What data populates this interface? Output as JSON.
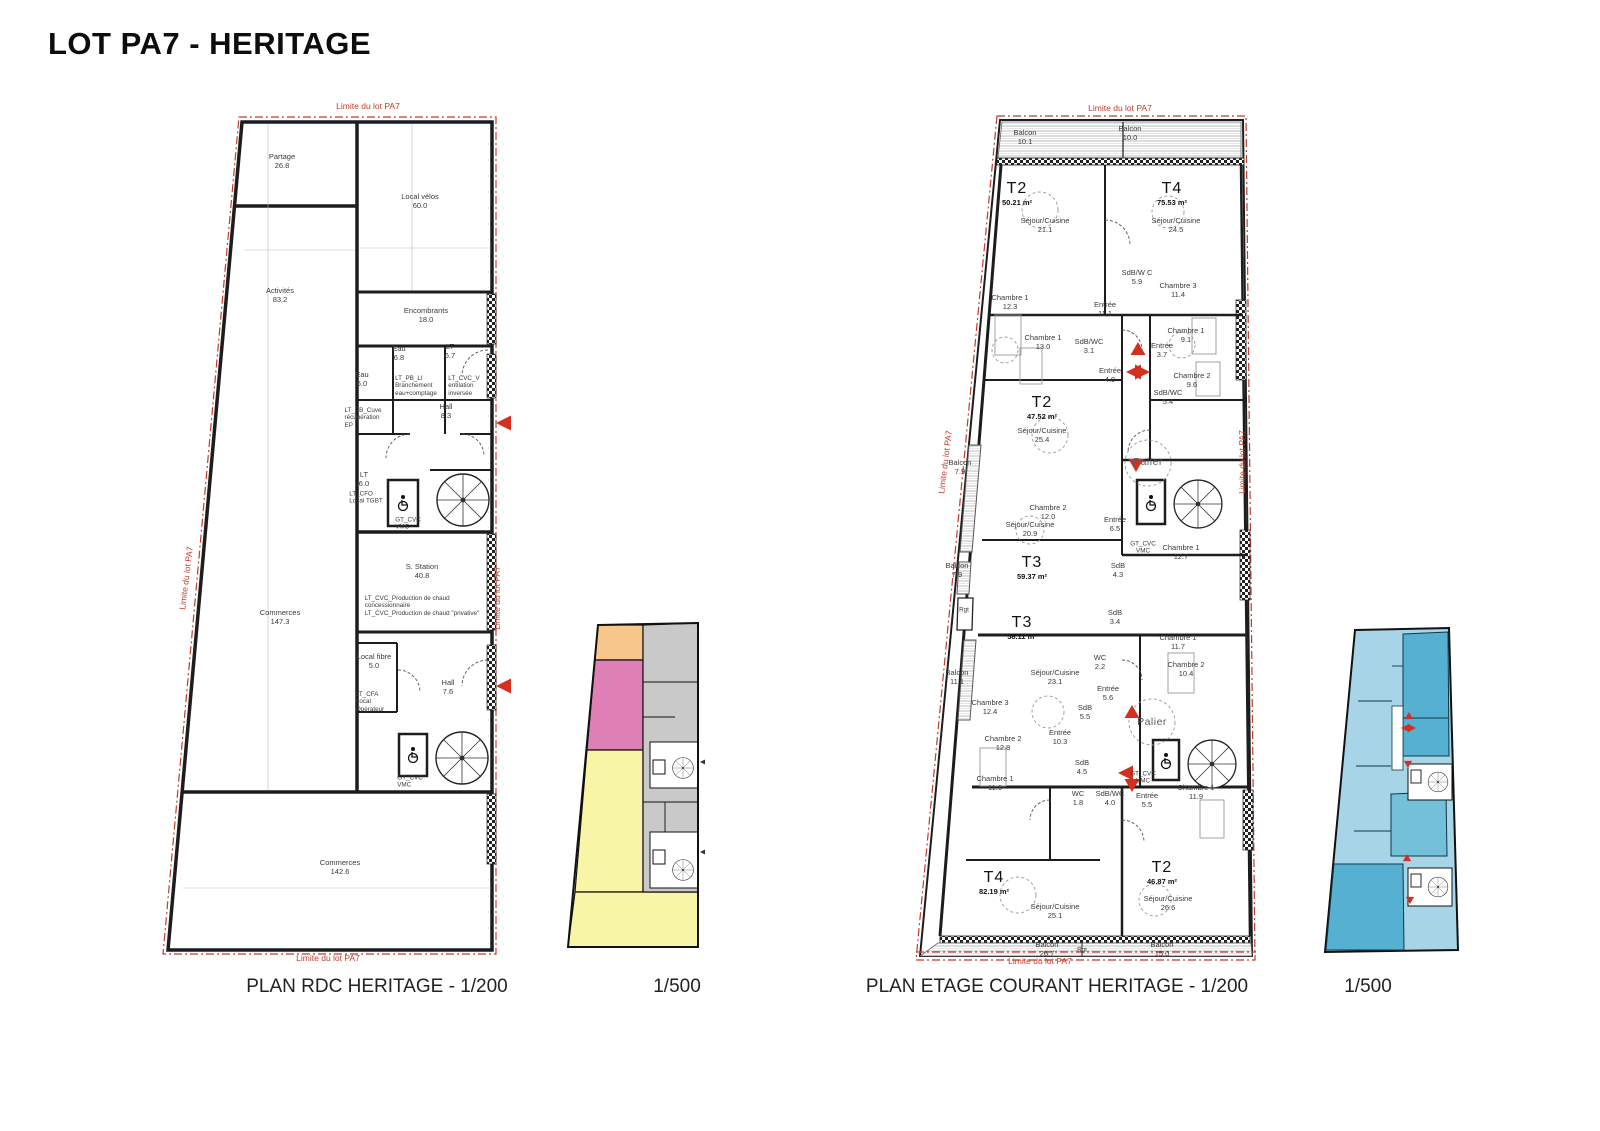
{
  "title": "LOT PA7 - HERITAGE",
  "boundary_label": "Limite du lot PA7",
  "captions": {
    "rdc": "PLAN RDC HERITAGE - 1/200",
    "rdc_key": "1/500",
    "etage": "PLAN ETAGE COURANT HERITAGE - 1/200",
    "etage_key": "1/500"
  },
  "colors": {
    "boundary_red": "#C23B2B",
    "wall_black": "#1D1D1D",
    "arrow_red": "#D43020",
    "key_orange": "#F6C68C",
    "key_pink": "#DE7FB5",
    "key_yellow": "#F8F6A6",
    "key_gray": "#C9C9C9",
    "key_blue_light": "#A7D4E6",
    "key_blue_dark": "#56B0D2"
  },
  "rdc": {
    "labels": [
      {
        "id": "room-partage",
        "x": 132,
        "y": 62,
        "t": [
          "Partage",
          "26.8"
        ]
      },
      {
        "id": "room-local-velos",
        "x": 270,
        "y": 102,
        "t": [
          "Local vélos",
          "60.0"
        ]
      },
      {
        "id": "room-activites",
        "x": 130,
        "y": 196,
        "t": [
          "Activités",
          "83.2"
        ]
      },
      {
        "id": "room-encombrants",
        "x": 276,
        "y": 216,
        "t": [
          "Encombrants",
          "18.0"
        ]
      },
      {
        "id": "room-eau-1",
        "x": 249,
        "y": 254,
        "t": [
          "Eau",
          "6.8"
        ]
      },
      {
        "id": "room-lt-1",
        "x": 300,
        "y": 252,
        "t": [
          "LT",
          "6.7"
        ]
      },
      {
        "id": "room-eau-2",
        "x": 212,
        "y": 280,
        "t": [
          "Eau",
          "6.0"
        ]
      },
      {
        "id": "room-lt-pb-li",
        "x": 266,
        "y": 286,
        "t": [
          "LT_PB_LI",
          "Branchement",
          "eau+comptage"
        ],
        "s": "small left"
      },
      {
        "id": "room-lt-cvc-vi",
        "x": 314,
        "y": 286,
        "t": [
          "LT_CVC_V",
          "entilation",
          "inversée"
        ],
        "s": "small left"
      },
      {
        "id": "room-lt-pb-cuve",
        "x": 213,
        "y": 318,
        "t": [
          "LT_PB_Cuve",
          "récupération",
          "EP"
        ],
        "s": "small left"
      },
      {
        "id": "room-hall-1",
        "x": 296,
        "y": 312,
        "t": [
          "Hall",
          "8.3"
        ]
      },
      {
        "id": "room-lt-2",
        "x": 214,
        "y": 380,
        "t": [
          "LT",
          "6.0"
        ]
      },
      {
        "id": "room-lt-cfo",
        "x": 216,
        "y": 398,
        "t": [
          "LT_CFO",
          "Local TGBT"
        ],
        "s": "small left"
      },
      {
        "id": "room-gt-cvc-1",
        "x": 258,
        "y": 424,
        "t": [
          "GT_CVC",
          "VMC"
        ],
        "s": "small left"
      },
      {
        "id": "room-commerces-1",
        "x": 130,
        "y": 518,
        "t": [
          "Commerces",
          "147.3"
        ]
      },
      {
        "id": "room-s-station",
        "x": 272,
        "y": 472,
        "t": [
          "S. Station",
          "40.8"
        ]
      },
      {
        "id": "note-production-chaud",
        "x": 272,
        "y": 506,
        "t": [
          "LT_CVC_Production de chaud",
          "concessionnaire",
          "LT_CVC_Production de chaud \"privative\""
        ],
        "s": "small left"
      },
      {
        "id": "room-local-fibre",
        "x": 224,
        "y": 562,
        "t": [
          "Local fibre",
          "5.0"
        ]
      },
      {
        "id": "room-lt-cfa",
        "x": 220,
        "y": 602,
        "t": [
          "LT_CFA",
          "Local",
          "Opérateur"
        ],
        "s": "small left"
      },
      {
        "id": "room-hall-2",
        "x": 298,
        "y": 588,
        "t": [
          "Hall",
          "7.6"
        ]
      },
      {
        "id": "room-gt-cvc-2",
        "x": 260,
        "y": 682,
        "t": [
          "GT_CVC",
          "VMC"
        ],
        "s": "small left"
      },
      {
        "id": "room-commerces-2",
        "x": 190,
        "y": 768,
        "t": [
          "Commerces",
          "142.6"
        ]
      },
      {
        "id": "boundary-top",
        "x": 218,
        "y": 6,
        "t": [
          "Limite du lot PA7"
        ],
        "s": "red"
      },
      {
        "id": "boundary-bottom",
        "x": 178,
        "y": 858,
        "t": [
          "Limite du lot PA7"
        ],
        "s": "red"
      },
      {
        "id": "boundary-left",
        "x": 36,
        "y": 478,
        "t": [
          "Limite du lot PA7"
        ],
        "s": "red rotl"
      },
      {
        "id": "boundary-right",
        "x": 347,
        "y": 498,
        "t": [
          "Limite du lot PA7"
        ],
        "s": "red rotr"
      }
    ]
  },
  "etage": {
    "labels": [
      {
        "id": "balcon-1",
        "x": 125,
        "y": 38,
        "t": [
          "Balcon",
          "10.1"
        ]
      },
      {
        "id": "balcon-2",
        "x": 230,
        "y": 34,
        "t": [
          "Balcon",
          "10.0"
        ]
      },
      {
        "id": "apt-t2-a",
        "x": 117,
        "y": 94,
        "t": [
          "T2",
          "50.21 m²"
        ],
        "s": "apt"
      },
      {
        "id": "sejour-cuisine-a",
        "x": 145,
        "y": 126,
        "t": [
          "Séjour/Cuisine",
          "21.1"
        ]
      },
      {
        "id": "apt-t4-a",
        "x": 272,
        "y": 94,
        "t": [
          "T4",
          "75.53 m²"
        ],
        "s": "apt"
      },
      {
        "id": "sejour-cuisine-b",
        "x": 276,
        "y": 126,
        "t": [
          "Séjour/Cuisine",
          "24.5"
        ]
      },
      {
        "id": "sdb-a",
        "x": 237,
        "y": 178,
        "t": [
          "SdB/W C",
          "5.9"
        ]
      },
      {
        "id": "chambre3-a",
        "x": 278,
        "y": 191,
        "t": [
          "Chambre 3",
          "11.4"
        ]
      },
      {
        "id": "chambre1-a",
        "x": 110,
        "y": 203,
        "t": [
          "Chambre 1",
          "12.3"
        ]
      },
      {
        "id": "entree-a",
        "x": 205,
        "y": 210,
        "t": [
          "Entrée",
          "11.1"
        ]
      },
      {
        "id": "chambre1-b",
        "x": 143,
        "y": 243,
        "t": [
          "Chambre 1",
          "13.0"
        ]
      },
      {
        "id": "sdb-b",
        "x": 189,
        "y": 247,
        "t": [
          "SdB/WC",
          "3.1"
        ]
      },
      {
        "id": "entree-b",
        "x": 262,
        "y": 251,
        "t": [
          "Entrée",
          "3.7"
        ]
      },
      {
        "id": "chambre1-c",
        "x": 286,
        "y": 236,
        "t": [
          "Chambre 1",
          "9.1"
        ]
      },
      {
        "id": "chambre2-a",
        "x": 292,
        "y": 281,
        "t": [
          "Chambre 2",
          "9.6"
        ]
      },
      {
        "id": "entree-c",
        "x": 210,
        "y": 276,
        "t": [
          "Entrée",
          "4.0"
        ]
      },
      {
        "id": "apt-t2-b",
        "x": 142,
        "y": 308,
        "t": [
          "T2",
          "47.52 m²"
        ],
        "s": "apt"
      },
      {
        "id": "sejour-cuisine-c",
        "x": 142,
        "y": 336,
        "t": [
          "Séjour/Cuisine",
          "25.4"
        ]
      },
      {
        "id": "sdb-c",
        "x": 268,
        "y": 298,
        "t": [
          "SdB/WC",
          "5.4"
        ]
      },
      {
        "id": "palier-1",
        "x": 248,
        "y": 362,
        "t": [
          "Palier"
        ],
        "s": "palier"
      },
      {
        "id": "balcon-3",
        "x": 60,
        "y": 368,
        "t": [
          "Balcon",
          "7.9"
        ]
      },
      {
        "id": "chambre2-b",
        "x": 148,
        "y": 413,
        "t": [
          "Chambre 2",
          "12.0"
        ]
      },
      {
        "id": "sejour-cuisine-d",
        "x": 130,
        "y": 430,
        "t": [
          "Séjour/Cuisine",
          "20.9"
        ]
      },
      {
        "id": "entree-d",
        "x": 215,
        "y": 425,
        "t": [
          "Entrée",
          "6.5"
        ]
      },
      {
        "id": "gt-cvc-a",
        "x": 243,
        "y": 448,
        "t": [
          "GT_CVC",
          "VMC"
        ],
        "s": "small"
      },
      {
        "id": "chambre1-d",
        "x": 281,
        "y": 453,
        "t": [
          "Chambre 1",
          "12.7"
        ]
      },
      {
        "id": "sdb-d",
        "x": 218,
        "y": 471,
        "t": [
          "SdB",
          "4.3"
        ]
      },
      {
        "id": "apt-t3-a",
        "x": 132,
        "y": 468,
        "t": [
          "T3",
          "59.37 m²"
        ],
        "s": "apt"
      },
      {
        "id": "balcon-4",
        "x": 57,
        "y": 471,
        "t": [
          "Balcon",
          "7.9"
        ]
      },
      {
        "id": "rgt-a",
        "x": 64,
        "y": 510,
        "t": [
          "Rgt"
        ],
        "s": "small"
      },
      {
        "id": "apt-t3-b",
        "x": 122,
        "y": 528,
        "t": [
          "T3",
          "58.11 m²"
        ],
        "s": "apt"
      },
      {
        "id": "sdb-e",
        "x": 215,
        "y": 518,
        "t": [
          "SdB",
          "3.4"
        ]
      },
      {
        "id": "chambre1-e",
        "x": 278,
        "y": 543,
        "t": [
          "Chambre 1",
          "11.7"
        ]
      },
      {
        "id": "wc-a",
        "x": 200,
        "y": 563,
        "t": [
          "WC",
          "2.2"
        ]
      },
      {
        "id": "sejour-cuisine-e",
        "x": 155,
        "y": 578,
        "t": [
          "Séjour/Cuisine",
          "23.1"
        ]
      },
      {
        "id": "chambre2-c",
        "x": 286,
        "y": 570,
        "t": [
          "Chambre 2",
          "10.4"
        ]
      },
      {
        "id": "balcon-5",
        "x": 57,
        "y": 578,
        "t": [
          "Balcon",
          "11.1"
        ]
      },
      {
        "id": "entree-e",
        "x": 208,
        "y": 594,
        "t": [
          "Entrée",
          "5.6"
        ]
      },
      {
        "id": "palier-2",
        "x": 252,
        "y": 622,
        "t": [
          "Palier"
        ],
        "s": "palier"
      },
      {
        "id": "chambre3-b",
        "x": 90,
        "y": 608,
        "t": [
          "Chambre 3",
          "12.4"
        ]
      },
      {
        "id": "sdb-f",
        "x": 185,
        "y": 613,
        "t": [
          "SdB",
          "5.5"
        ]
      },
      {
        "id": "chambre2-d",
        "x": 103,
        "y": 644,
        "t": [
          "Chambre 2",
          "12.8"
        ]
      },
      {
        "id": "entree-f",
        "x": 160,
        "y": 638,
        "t": [
          "Entrée",
          "10.3"
        ]
      },
      {
        "id": "sdb-g",
        "x": 182,
        "y": 668,
        "t": [
          "SdB",
          "4.5"
        ]
      },
      {
        "id": "gt-cvc-b",
        "x": 243,
        "y": 678,
        "t": [
          "GT_CVC",
          "VMC"
        ],
        "s": "small"
      },
      {
        "id": "entree-g",
        "x": 247,
        "y": 701,
        "t": [
          "Entrée",
          "5.5"
        ]
      },
      {
        "id": "chambre1-f",
        "x": 95,
        "y": 684,
        "t": [
          "Chambre 1",
          "11.6"
        ]
      },
      {
        "id": "wc-b",
        "x": 178,
        "y": 699,
        "t": [
          "WC",
          "1.8"
        ]
      },
      {
        "id": "sdb-h",
        "x": 210,
        "y": 699,
        "t": [
          "SdB/WC",
          "4.0"
        ]
      },
      {
        "id": "chambre1-g",
        "x": 296,
        "y": 693,
        "t": [
          "Chambre 1",
          "11.9"
        ]
      },
      {
        "id": "apt-t4-b",
        "x": 94,
        "y": 783,
        "t": [
          "T4",
          "82.19 m²"
        ],
        "s": "apt"
      },
      {
        "id": "sejour-cuisine-f",
        "x": 155,
        "y": 812,
        "t": [
          "Séjour/Cuisine",
          "25.1"
        ]
      },
      {
        "id": "apt-t2-c",
        "x": 262,
        "y": 773,
        "t": [
          "T2",
          "46.87 m²"
        ],
        "s": "apt"
      },
      {
        "id": "sejour-cuisine-g",
        "x": 268,
        "y": 804,
        "t": [
          "Séjour/Cuisine",
          "26.6"
        ]
      },
      {
        "id": "balcon-6",
        "x": 147,
        "y": 850,
        "t": [
          "Balcon",
          "26.7"
        ]
      },
      {
        "id": "rgt-b",
        "x": 182,
        "y": 850,
        "t": [
          "Rgt"
        ],
        "s": "small"
      },
      {
        "id": "balcon-7",
        "x": 262,
        "y": 850,
        "t": [
          "Balcon",
          "15.0"
        ]
      },
      {
        "id": "boundary-top",
        "x": 220,
        "y": 8,
        "t": [
          "Limite du lot PA7"
        ],
        "s": "red"
      },
      {
        "id": "boundary-bottom",
        "x": 140,
        "y": 861,
        "t": [
          "Limite du lot PA7"
        ],
        "s": "red"
      },
      {
        "id": "boundary-left",
        "x": 45,
        "y": 362,
        "t": [
          "Limite du lot PA7"
        ],
        "s": "red rotl"
      },
      {
        "id": "boundary-right",
        "x": 342,
        "y": 362,
        "t": [
          "Limite du lot PA7"
        ],
        "s": "red rotr"
      }
    ]
  }
}
